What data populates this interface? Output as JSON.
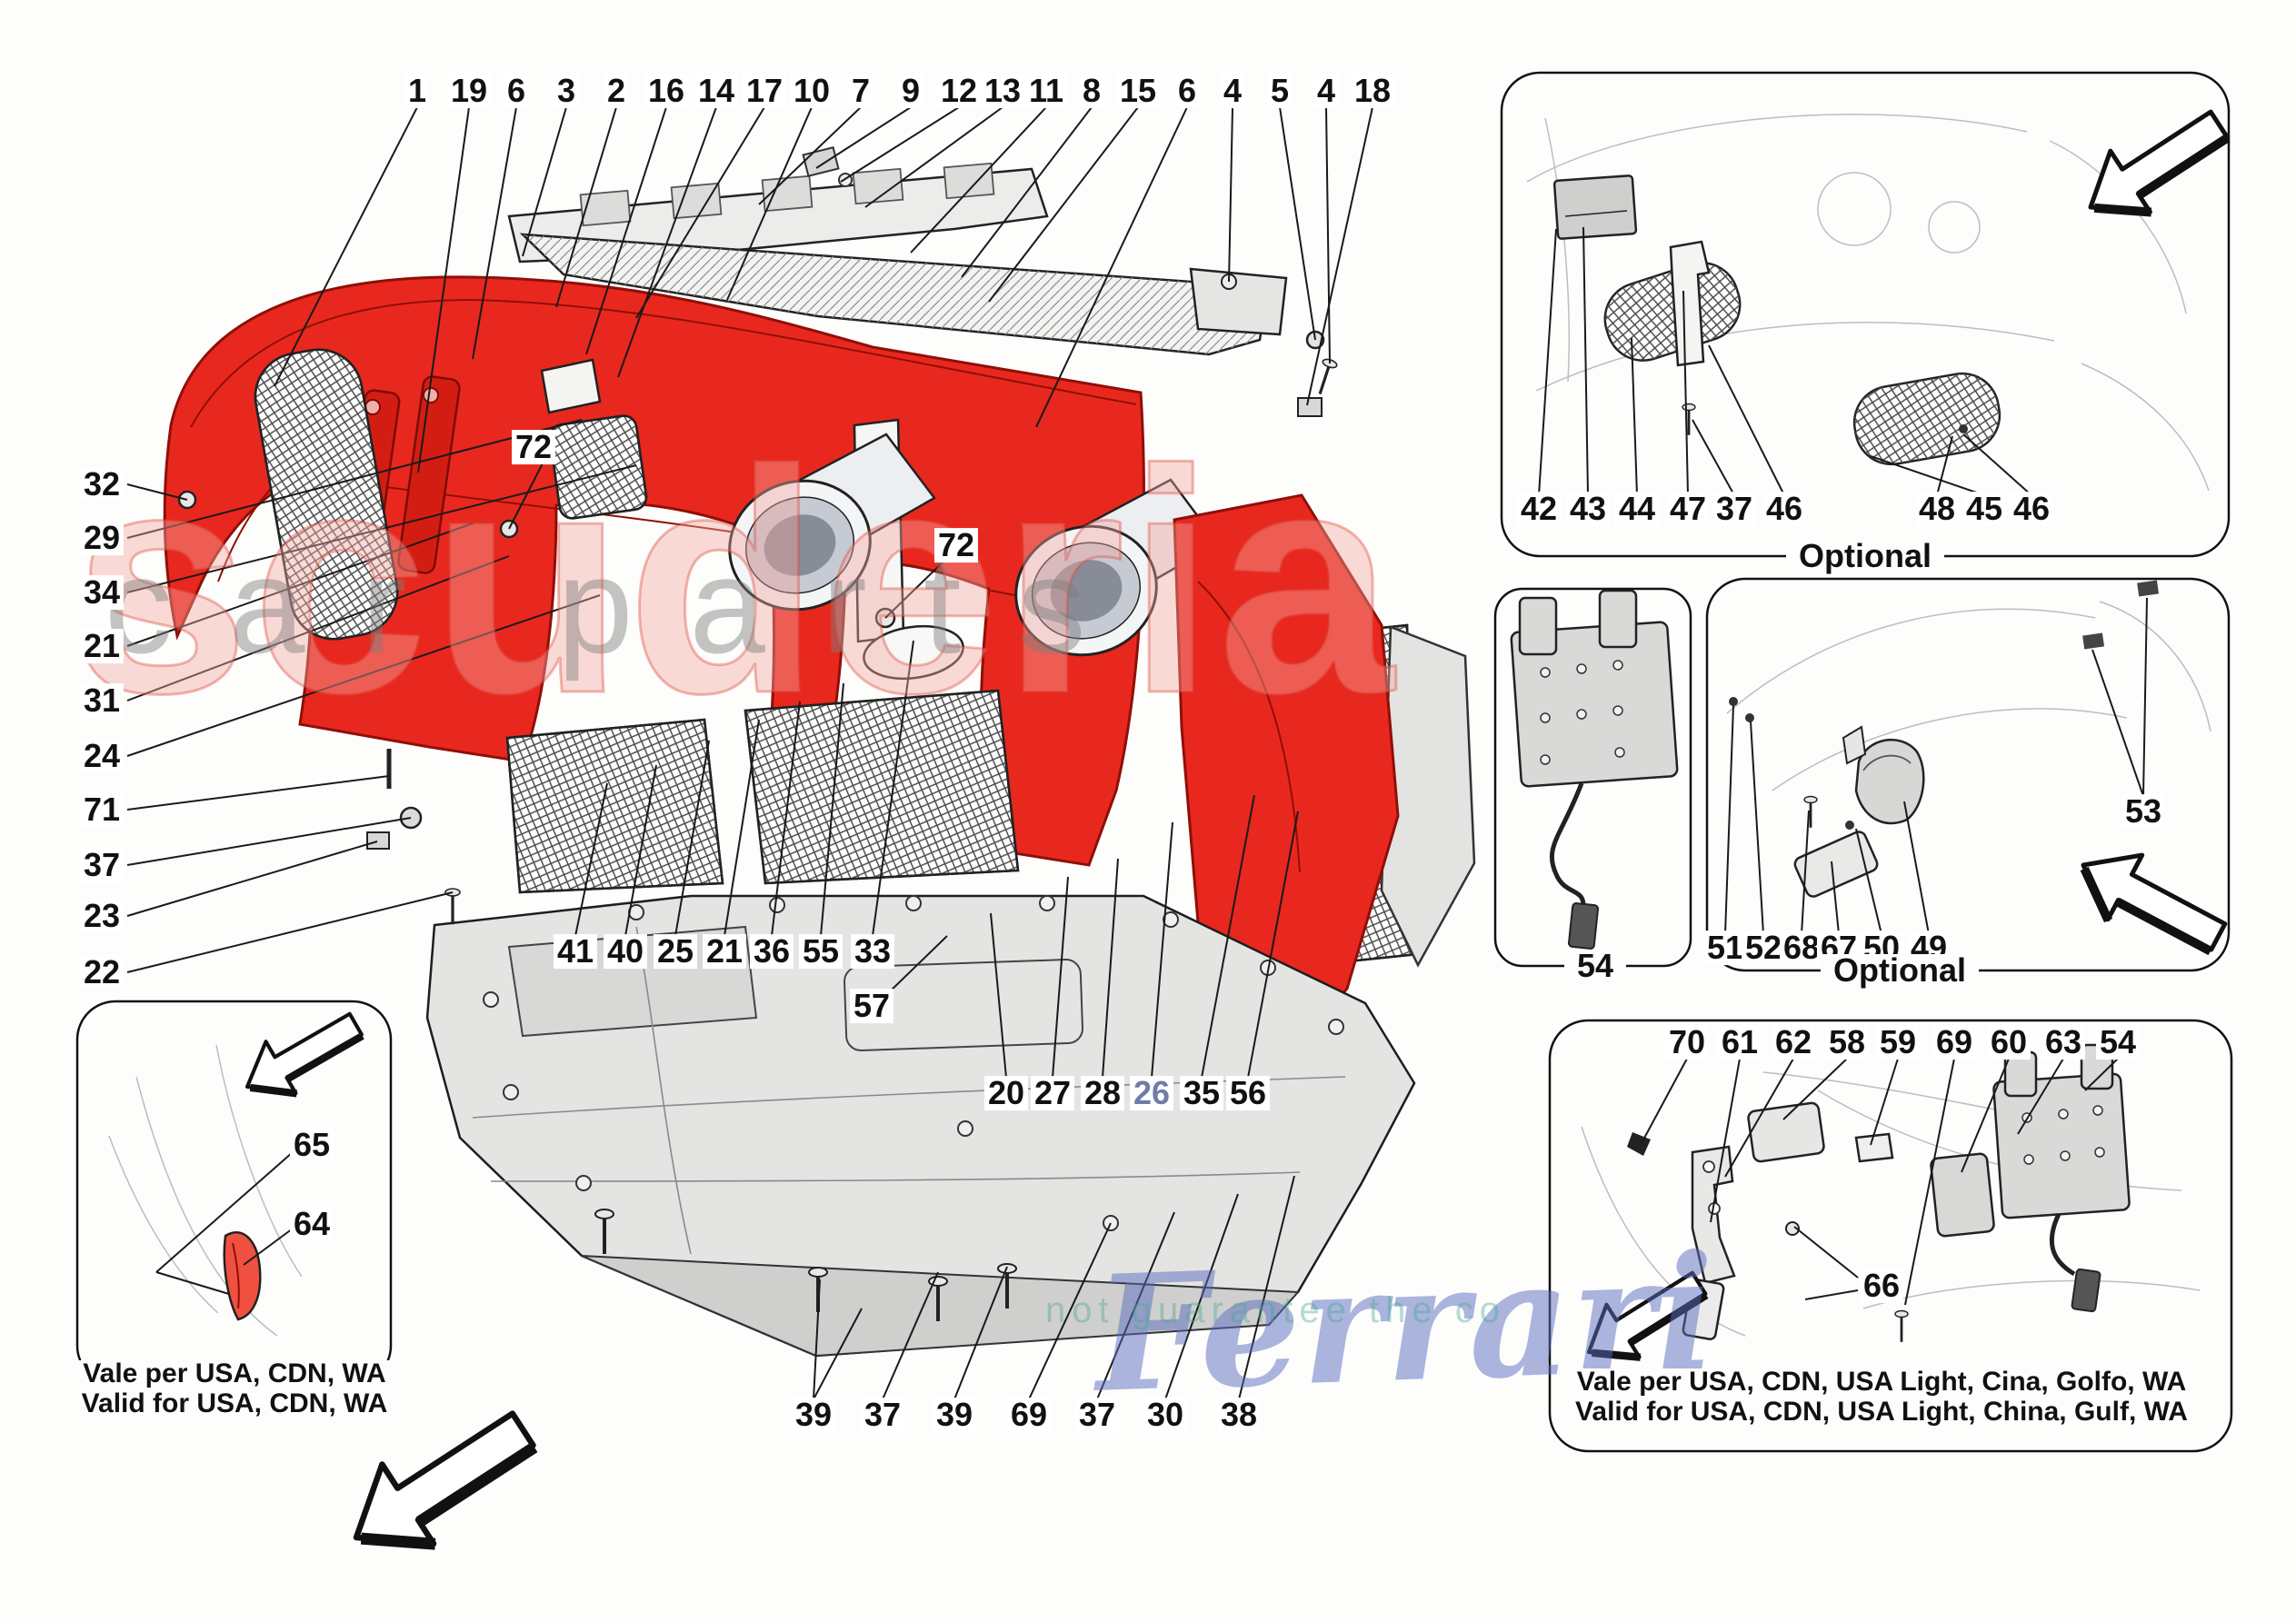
{
  "colors": {
    "bumper_red": "#e8281e",
    "bumper_red_dark": "#8f0f08",
    "label_blue": "#6e7da8",
    "line": "#1a1a1a"
  },
  "watermarks": {
    "brand": "scuderia",
    "brand2": "car parts",
    "script": "Ferrari",
    "fragment": "not guarantee the co"
  },
  "callouts": {
    "top_row": [
      "1",
      "19",
      "6",
      "3",
      "2",
      "16",
      "14",
      "17",
      "10",
      "7",
      "9",
      "12",
      "13",
      "11",
      "8",
      "15",
      "6",
      "4",
      "5",
      "4",
      "18"
    ],
    "left_col": [
      "32",
      "29",
      "34",
      "21",
      "31",
      "24",
      "71",
      "37",
      "23",
      "22"
    ],
    "mid_row1": [
      "41",
      "40",
      "25",
      "21",
      "36",
      "55",
      "33"
    ],
    "mid_row2": [
      "20",
      "27",
      "28",
      "26",
      "35",
      "56"
    ],
    "bottom_row": [
      "39",
      "37",
      "39",
      "69",
      "37",
      "30",
      "38"
    ],
    "label_57": "57",
    "label_72": "72",
    "label_53": "53",
    "label_66": "66",
    "label_65": "65",
    "label_64": "64"
  },
  "insets": {
    "top_right": {
      "row": [
        "42",
        "43",
        "44",
        "47",
        "37",
        "46",
        "48",
        "45",
        "46"
      ],
      "caption": "Optional"
    },
    "plate": {
      "label": "54"
    },
    "mid_right": {
      "row": [
        "51",
        "52",
        "68",
        "67",
        "50",
        "49"
      ],
      "caption": "Optional"
    },
    "bottom_right": {
      "row": [
        "70",
        "61",
        "62",
        "58",
        "59",
        "69",
        "60",
        "63",
        "54"
      ],
      "note1": "Vale per USA, CDN, USA Light, Cina, Golfo, WA",
      "note2": "Valid for USA, CDN, USA Light, China, Gulf, WA"
    },
    "bottom_left": {
      "note1": "Vale per USA, CDN, WA",
      "note2": "Valid for USA, CDN, WA"
    }
  }
}
